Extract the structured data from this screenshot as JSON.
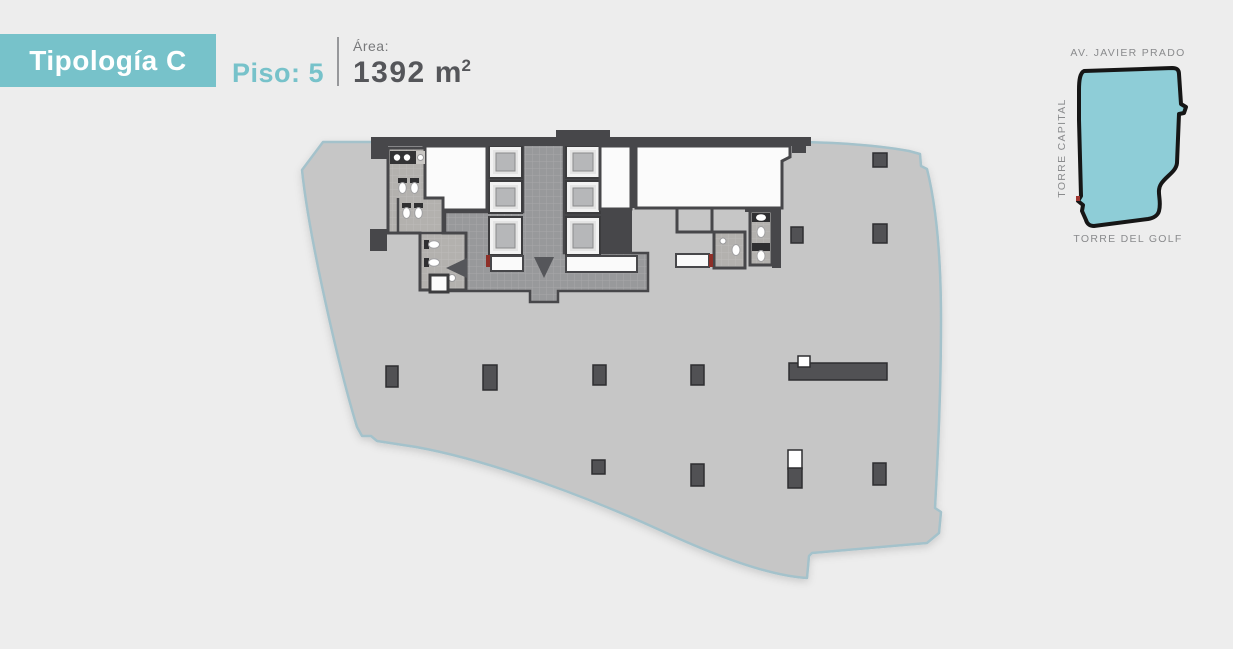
{
  "header": {
    "typology": "Tipología C",
    "floor": "Piso: 5",
    "area_label": "Área:",
    "area_value": "1392",
    "area_unit": "m",
    "area_sup": "2"
  },
  "minimap": {
    "top_label": "AV. JAVIER PRADO",
    "side_label": "TORRE CAPITAL",
    "bottom_label": "TORRE DEL GOLF"
  },
  "floorplan": {
    "arrows": [
      "left",
      "down"
    ],
    "elevator_count": 6
  },
  "colors": {
    "accent_teal": "#77c2ca",
    "minimap_fill": "#8ecdd7",
    "value_text": "#55565a",
    "label_text": "#8a8b8d",
    "slab_fill": "#c6c6c6",
    "wall_dark": "#47474a",
    "slab_outline": "#a4c2cb",
    "door_marker_red": "#8e2f28"
  }
}
